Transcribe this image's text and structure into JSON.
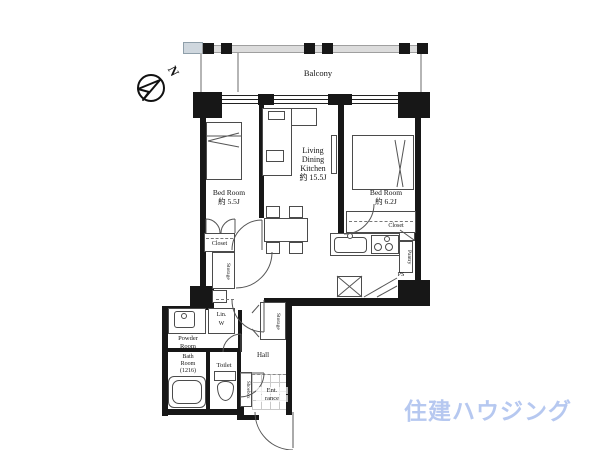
{
  "compass": {
    "north_label": "N"
  },
  "balcony": {
    "label": "Balcony"
  },
  "rooms": {
    "bedroom1": {
      "name": "Bed Room",
      "size": "約 5.5J"
    },
    "bedroom2": {
      "name": "Bed Room",
      "size": "約 6.2J"
    },
    "ldk": {
      "line1": "Living",
      "line2": "Dining",
      "line3": "Kitchen",
      "size": "約 15.5J"
    },
    "powder": {
      "line1": "Powder",
      "line2": "Room"
    },
    "bath": {
      "line1": "Bath",
      "line2": "Room",
      "line3": "(1216)"
    },
    "toilet": {
      "label": "Toilet"
    },
    "hall": {
      "label": "Hall"
    },
    "entrance": {
      "line1": "Ent.",
      "line2": "rance"
    }
  },
  "fixtures": {
    "closet1": "Closet",
    "closet2": "Closet",
    "storage_bedroom": "Storage",
    "storage_hall": "Storage",
    "pantry": "Pantry",
    "ps": "PS",
    "linen_line1": "Lin.",
    "linen_line2": "W",
    "shoebox": "Shoebox"
  },
  "watermark": {
    "text": "住建ハウジング",
    "color": "#b6c8f0"
  },
  "colors": {
    "wall": "#171717",
    "line": "#4b4b4b",
    "balcony_rail": "#dcdcdc"
  }
}
